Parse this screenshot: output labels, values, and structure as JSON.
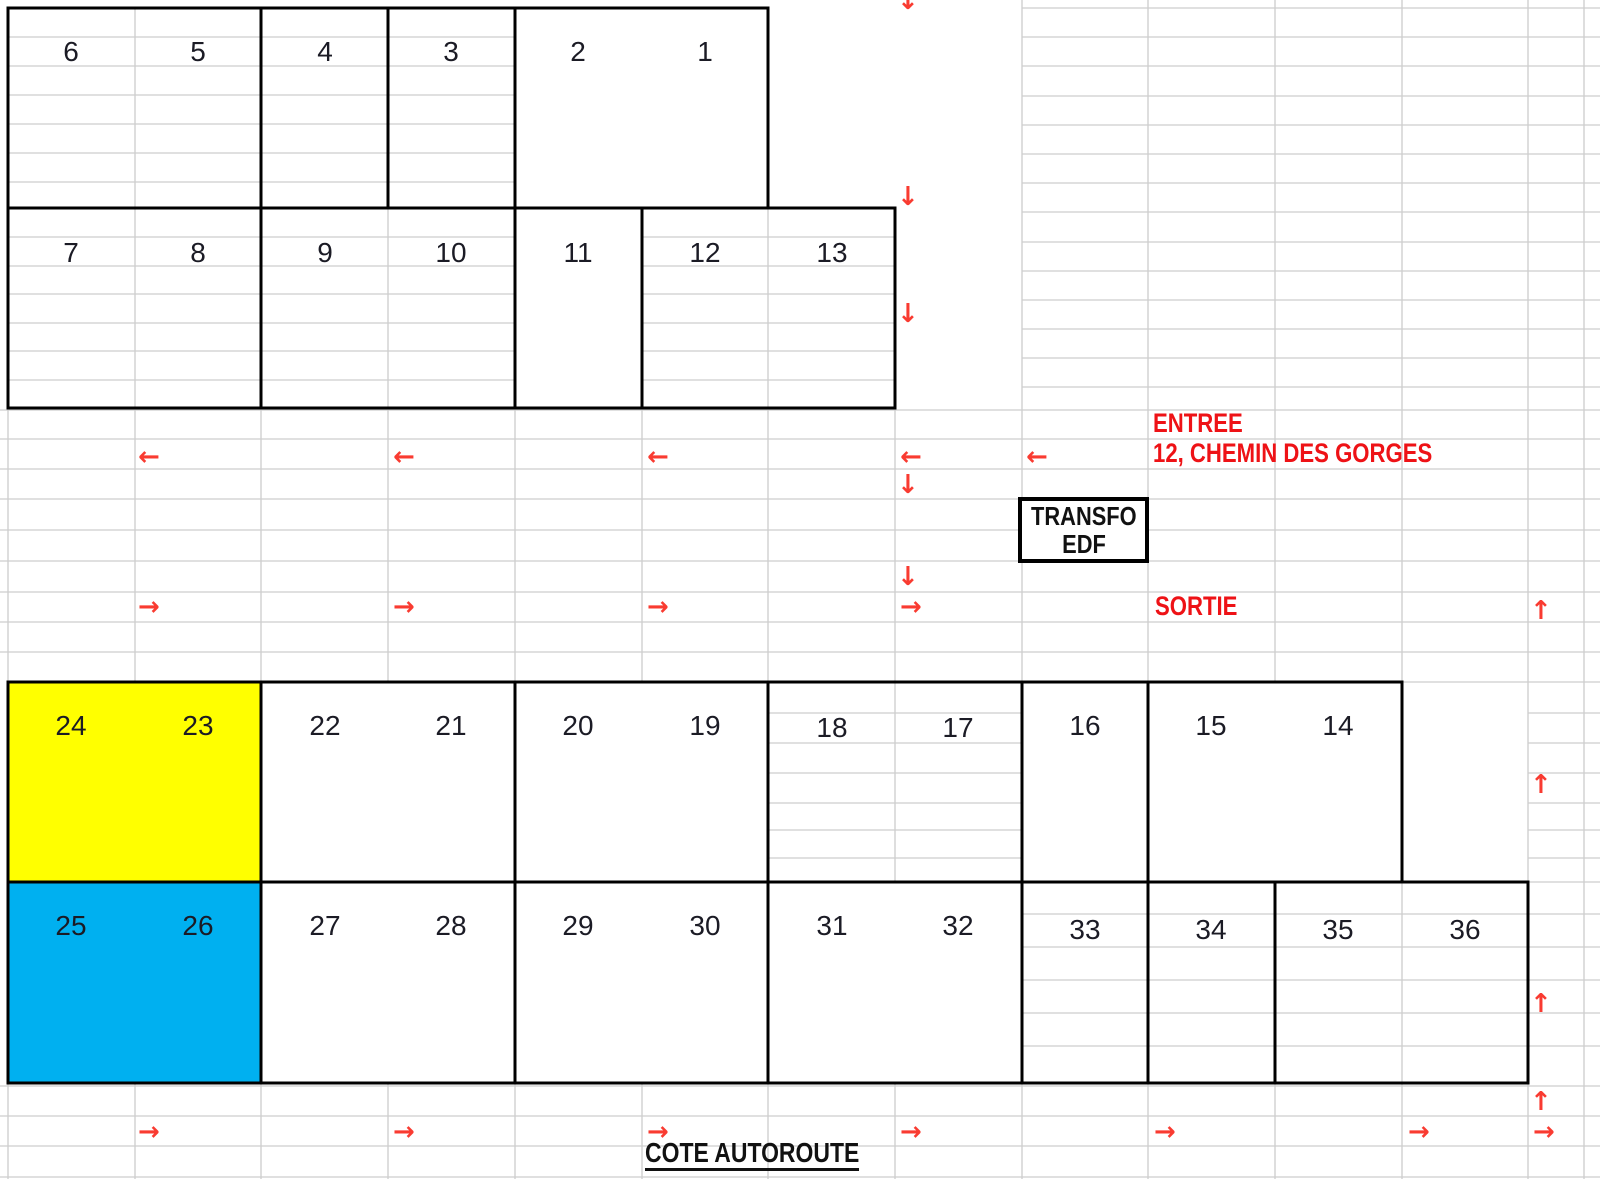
{
  "colors": {
    "plot_highlight_yellow": "#FFFF00",
    "plot_highlight_cyan": "#00B0F0",
    "red_label": "#EE1216",
    "red_arrow": "#F93B31",
    "grid_line": "#CDCDCD",
    "block_border": "#000000",
    "number_text": "#1B1B25"
  },
  "labels": {
    "entree": "ENTREE",
    "address": "12, CHEMIN DES GORGES",
    "sortie": "SORTIE",
    "transfo_line1": "TRANSFO",
    "transfo_line2": "EDF",
    "cote_autoroute": "COTE AUTOROUTE"
  },
  "icons": {
    "arrow_left": "←",
    "arrow_right": "→",
    "arrow_up": "↑",
    "arrow_down": "↓"
  },
  "parcels": {
    "b_6_5": [
      "6",
      "5"
    ],
    "b_4": [
      "4"
    ],
    "b_3": [
      "3"
    ],
    "b_2_1": [
      "2",
      "1"
    ],
    "b_7_8": [
      "7",
      "8"
    ],
    "b_9_10": [
      "9",
      "10"
    ],
    "b_11": [
      "11"
    ],
    "b_12_13": [
      "12",
      "13"
    ],
    "b_24_23": [
      "24",
      "23"
    ],
    "b_22_21": [
      "22",
      "21"
    ],
    "b_20_19": [
      "20",
      "19"
    ],
    "b_18_17": [
      "18",
      "17"
    ],
    "b_16": [
      "16"
    ],
    "b_15_14": [
      "15",
      "14"
    ],
    "b_25_26": [
      "25",
      "26"
    ],
    "b_27_28": [
      "27",
      "28"
    ],
    "b_29_30": [
      "29",
      "30"
    ],
    "b_31_32": [
      "31",
      "32"
    ],
    "b_33": [
      "33"
    ],
    "b_34": [
      "34"
    ],
    "b_35_36": [
      "35",
      "36"
    ]
  }
}
